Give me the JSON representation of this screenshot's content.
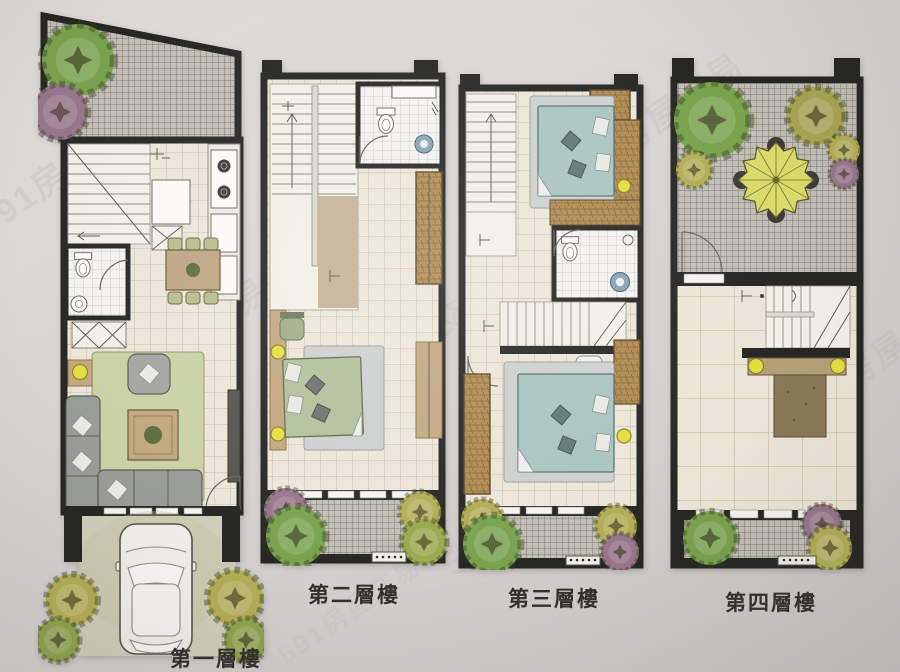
{
  "title": "multi-floor residential floor plan photo",
  "watermark": {
    "text": "591房屋交易"
  },
  "floors": [
    {
      "label": "第一層樓",
      "name": "first-floor"
    },
    {
      "label": "第二層樓",
      "name": "second-floor"
    },
    {
      "label": "第三層樓",
      "name": "third-floor"
    },
    {
      "label": "第四層樓",
      "name": "fourth-floor"
    }
  ],
  "colors": {
    "wall": "#262624",
    "paper": "#d6d3d0",
    "floor_tile": "#ece6d9",
    "patio": "#c2beb5",
    "wood": "#b28c52",
    "rug": "#c9d1a4",
    "sofa": "#999c96",
    "bed_green": "#b2c09a",
    "bed_teal": "#a9c5c1",
    "lamp": "#e6de3f",
    "tan": "#c2a87f",
    "sink_blue": "#8aa3b2",
    "tree_green": "#79a24e",
    "tree_olive": "#b3ad58",
    "tree_purple": "#97768b",
    "umbrella": "#dcda6a",
    "car": "#efede8",
    "driveway": "#cfcdb9"
  }
}
